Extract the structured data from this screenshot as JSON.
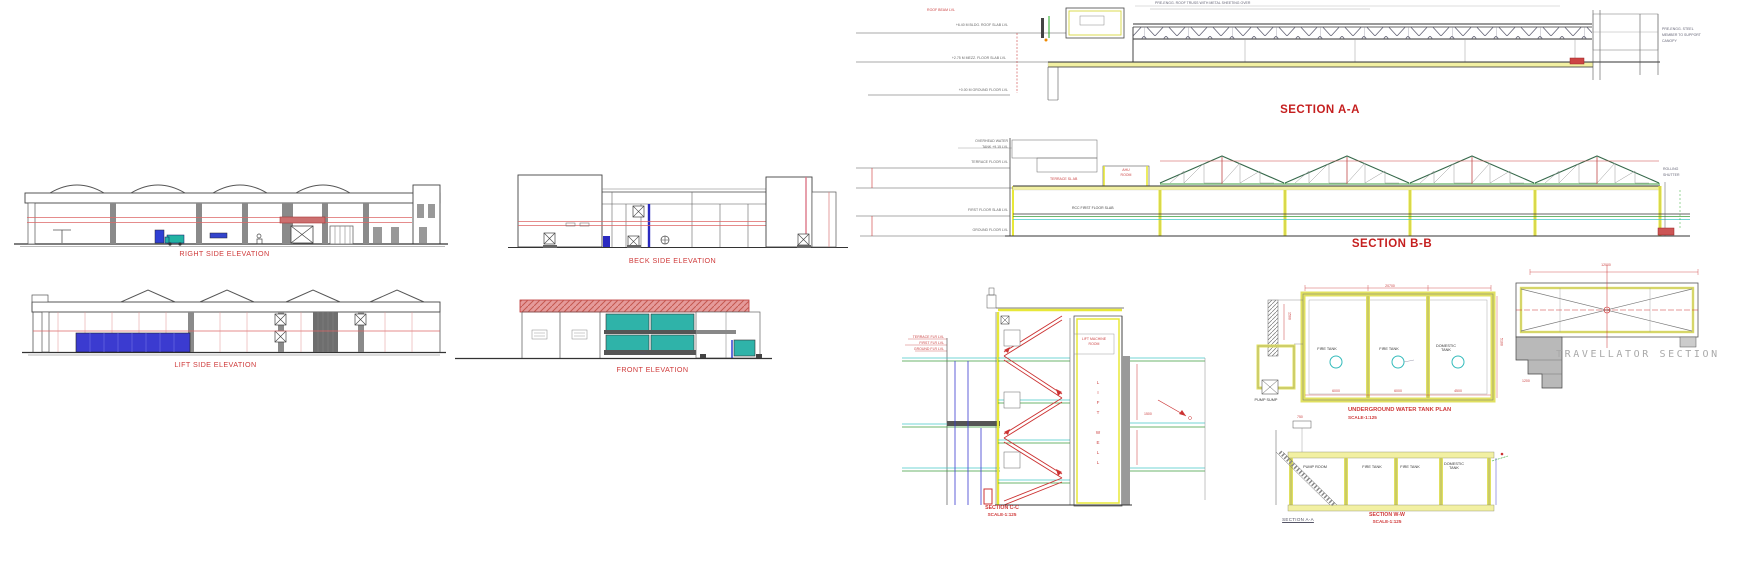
{
  "sheet": {
    "type": "architectural drawing sheet",
    "background": "#ffffff"
  },
  "colors": {
    "label_red": "#cf3a3a",
    "title_red": "#c51f1f",
    "cad_yellow": "#e8e838",
    "cad_cyan": "#45c8c8",
    "cad_green": "#3c9e3c",
    "cad_blue": "#3b3bd0",
    "glass_teal": "#2fb3a9",
    "roof_salmon": "#e59a9a"
  },
  "views": {
    "right_side_elevation": {
      "label": "RIGHT SIDE ELEVATION"
    },
    "beck_side_elevation": {
      "label": "BECK SIDE ELEVATION"
    },
    "lift_side_elevation": {
      "label": "LIFT SIDE ELEVATION"
    },
    "front_elevation": {
      "label": "FRONT ELEVATION"
    },
    "section_aa": {
      "label": "SECTION A-A"
    },
    "section_bb": {
      "label": "SECTION B-B"
    },
    "section_cc": {
      "label": "SECTION C-C",
      "scale": "SCALE-1:125"
    },
    "underground_water_tank_plan": {
      "label": "UNDERGROUND WATER TANK PLAN",
      "scale": "SCALE-1:125",
      "cells": [
        "FIRE TANK",
        "FIRE TANK",
        "DOMESTIC TANK"
      ],
      "sump_note": "PUMP SUMP"
    },
    "section_ww": {
      "label": "SECTION W-W",
      "scale": "SCALE-1:125",
      "sub_label": "SECTION  A-A",
      "cells": [
        "PUMP ROOM",
        "FIRE TANK",
        "FIRE TANK",
        "DOMESTIC TANK"
      ]
    },
    "travellator_section": {
      "label": "TRAVELLATOR SECTION"
    },
    "stair_section": {
      "lift_well": "L\nI\nF\nT\n\nW\nE\nL\nL"
    }
  },
  "annotations": [
    {
      "x": 1008,
      "y": 24,
      "t": "+6.40 M BLDG. ROOF SLAB LVL",
      "c": "#666",
      "al": "r"
    },
    {
      "x": 1006,
      "y": 57,
      "t": "+2.75 M MEZZ. FLOOR SLAB LVL",
      "c": "#666",
      "al": "r"
    },
    {
      "x": 1008,
      "y": 89,
      "t": "+0.00 M GROUND FLOOR LVL",
      "c": "#666",
      "al": "r"
    },
    {
      "x": 955,
      "y": 9,
      "t": "ROOF BEAM LVL",
      "c": "#c44",
      "al": "r"
    },
    {
      "x": 1155,
      "y": 2,
      "t": "PRE-ENGG. ROOF TRUSS WITH METAL SHEETING OVER",
      "c": "#667"
    },
    {
      "x": 1662,
      "y": 28,
      "t": "PRE-ENGG. STEEL",
      "c": "#667"
    },
    {
      "x": 1662,
      "y": 34,
      "t": "MEMBER TO SUPPORT",
      "c": "#667"
    },
    {
      "x": 1662,
      "y": 40,
      "t": "CANOPY",
      "c": "#667"
    },
    {
      "x": 1008,
      "y": 140,
      "t": "OVERHEAD WATER",
      "c": "#666",
      "al": "r"
    },
    {
      "x": 1008,
      "y": 146,
      "t": "TANK  +9.15 LVL",
      "c": "#666",
      "al": "r"
    },
    {
      "x": 1008,
      "y": 161,
      "t": "TERRACE FLOOR LVL",
      "c": "#666",
      "al": "r"
    },
    {
      "x": 1008,
      "y": 209,
      "t": "FIRST FLOOR SLAB LVL",
      "c": "#666",
      "al": "r"
    },
    {
      "x": 1008,
      "y": 229,
      "t": "GROUND FLOOR LVL",
      "c": "#666",
      "al": "r"
    },
    {
      "x": 1050,
      "y": 178,
      "t": "TERRACE SL AB",
      "c": "#c44"
    },
    {
      "x": 1072,
      "y": 207,
      "t": "RCC FIRST FLOOR SLAB",
      "c": "#444"
    },
    {
      "x": 1126,
      "y": 169,
      "t": "AHU",
      "c": "#c44",
      "al": "c"
    },
    {
      "x": 1126,
      "y": 174,
      "t": "ROOM",
      "c": "#c44",
      "al": "c"
    },
    {
      "x": 1663,
      "y": 168,
      "t": "ROLLING",
      "c": "#667"
    },
    {
      "x": 1663,
      "y": 174,
      "t": "SHUTTER",
      "c": "#667"
    },
    {
      "x": 944,
      "y": 336,
      "t": "TERRACE FLR LVL",
      "c": "#c44",
      "al": "r"
    },
    {
      "x": 944,
      "y": 342,
      "t": "FIRST FLR LVL",
      "c": "#c44",
      "al": "r"
    },
    {
      "x": 944,
      "y": 348,
      "t": "GROUND FLR LVL",
      "c": "#c44",
      "al": "r"
    },
    {
      "x": 1094,
      "y": 338,
      "t": "LIFT MACHINE",
      "c": "#c44",
      "al": "c"
    },
    {
      "x": 1094,
      "y": 343,
      "t": "ROOM",
      "c": "#c44",
      "al": "c"
    },
    {
      "x": 1144,
      "y": 413,
      "t": "1500",
      "c": "#c44"
    },
    {
      "x": 1390,
      "y": 285,
      "t": "20700",
      "c": "#c44",
      "al": "c"
    },
    {
      "x": 1336,
      "y": 390,
      "t": "6000",
      "c": "#c44",
      "al": "c"
    },
    {
      "x": 1398,
      "y": 390,
      "t": "6000",
      "c": "#c44",
      "al": "c"
    },
    {
      "x": 1458,
      "y": 390,
      "t": "4500",
      "c": "#c44",
      "al": "c"
    },
    {
      "x": 1499,
      "y": 338,
      "t": "5100",
      "c": "#c44",
      "v": 1
    },
    {
      "x": 1287,
      "y": 312,
      "t": "1500",
      "c": "#c44",
      "v": 1
    },
    {
      "x": 1297,
      "y": 416,
      "t": "750",
      "c": "#c44"
    },
    {
      "x": 1606,
      "y": 264,
      "t": "12000",
      "c": "#c44",
      "al": "c"
    },
    {
      "x": 1522,
      "y": 380,
      "t": "1200",
      "c": "#c44"
    },
    {
      "x": 640,
      "y": 352,
      "t": "WAL",
      "c": "#556"
    }
  ]
}
